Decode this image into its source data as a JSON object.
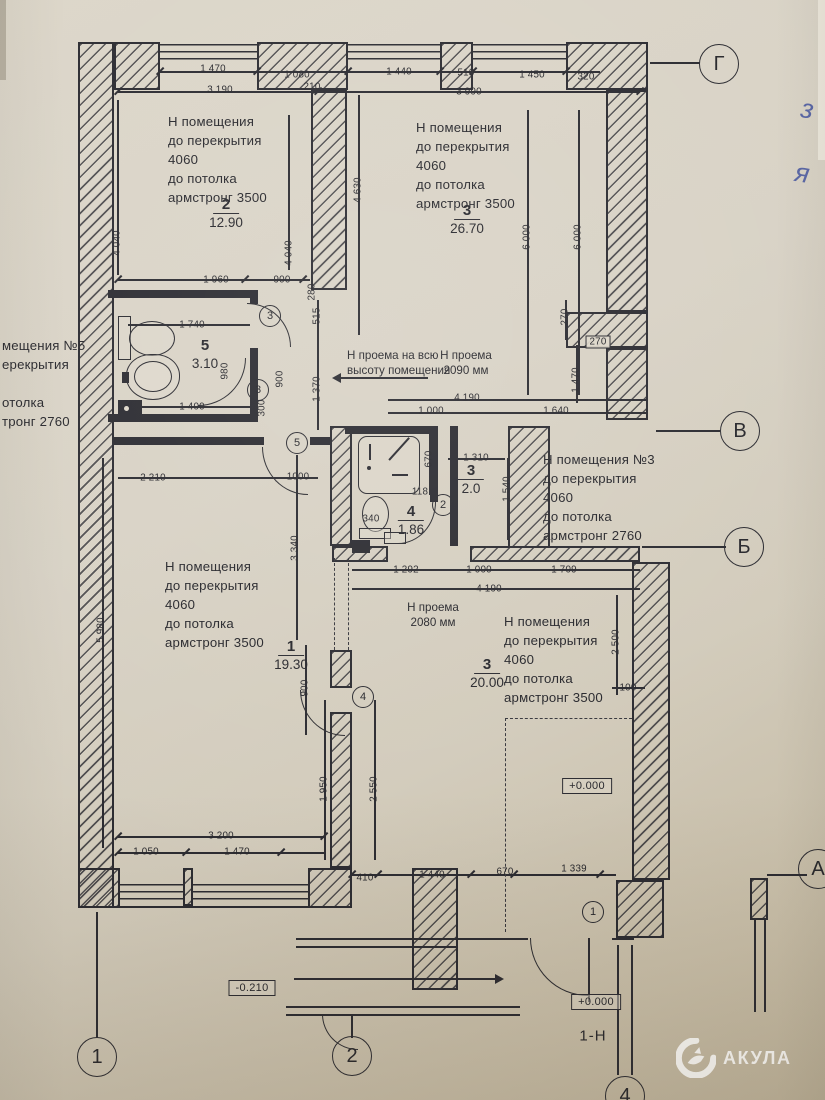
{
  "watermark": {
    "brand": "АКУЛА",
    "logo": "shark-icon"
  },
  "handwriting": {
    "mark1": "з",
    "mark2": "я"
  },
  "entrance_label": "1-Н",
  "icons": {
    "fixtures": [
      "toilet-icon",
      "sink-icon",
      "shower-icon",
      "washer-icon",
      "drain-icon"
    ],
    "watermark_logo": "shark-icon",
    "direction_arrow": "right-arrow-icon",
    "opening_arrow": "left-arrow-icon"
  },
  "axes": [
    {
      "label": "Г",
      "x": 719,
      "y": 64
    },
    {
      "label": "В",
      "x": 740,
      "y": 431
    },
    {
      "label": "Б",
      "x": 744,
      "y": 547
    },
    {
      "label": "А",
      "x": 818,
      "y": 869
    },
    {
      "label": "1",
      "x": 97,
      "y": 1057
    },
    {
      "label": "2",
      "x": 352,
      "y": 1056
    },
    {
      "label": "4",
      "x": 625,
      "y": 1096
    }
  ],
  "door_tags": [
    {
      "label": "3",
      "x": 270,
      "y": 316
    },
    {
      "label": "3",
      "x": 258,
      "y": 390
    },
    {
      "label": "5",
      "x": 297,
      "y": 443
    },
    {
      "label": "2",
      "x": 443,
      "y": 505
    },
    {
      "label": "4",
      "x": 363,
      "y": 697
    },
    {
      "label": "1",
      "x": 593,
      "y": 912
    }
  ],
  "rooms": [
    {
      "name": "room-2",
      "note_x": 168,
      "note_y": 112,
      "lines": [
        "Н помещения",
        "до перекрытия",
        "4060",
        "до потолка",
        "армстронг 3500"
      ],
      "num": "2",
      "area": "12.90",
      "num_x": 226,
      "num_y": 196
    },
    {
      "name": "room-3-top",
      "note_x": 416,
      "note_y": 118,
      "lines": [
        "Н помещения",
        "до перекрытия",
        "4060",
        "до потолка",
        "армстронг 3500"
      ],
      "num": "3",
      "area": "26.70",
      "num_x": 467,
      "num_y": 202
    },
    {
      "name": "room-5",
      "num": "5",
      "area": "3.10",
      "num_x": 205,
      "num_y": 337,
      "bar": false
    },
    {
      "name": "room-3-mid",
      "num": "3",
      "area": "2.0",
      "num_x": 471,
      "num_y": 462
    },
    {
      "name": "room-4",
      "num": "4",
      "area": "1.86",
      "num_x": 411,
      "num_y": 503
    },
    {
      "name": "room-1",
      "note_x": 165,
      "note_y": 557,
      "lines": [
        "Н помещения",
        "до перекрытия",
        "4060",
        "до потолка",
        "армстронг 3500"
      ],
      "num": "1",
      "area": "19.30",
      "num_x": 291,
      "num_y": 638
    },
    {
      "name": "room-3-bottom",
      "note_x": 504,
      "note_y": 612,
      "lines": [
        "Н помещения",
        "до перекрытия",
        "4060",
        "до потолка",
        "армстронг 3500"
      ],
      "num": "3",
      "area": "20.00",
      "num_x": 487,
      "num_y": 656
    },
    {
      "name": "note-room-3",
      "note_x": 543,
      "note_y": 450,
      "lines": [
        "Н помещения №3",
        "до перекрытия",
        "4060",
        "до потолка",
        "армстронг 2760"
      ]
    },
    {
      "name": "note-left-cut",
      "note_x": 2,
      "note_y": 336,
      "lines": [
        "мещения №5",
        "ерекрытия",
        "",
        "отолка",
        "тронг 2760"
      ]
    }
  ],
  "openings": [
    {
      "name": "opening-full-height",
      "x": 347,
      "y": 348,
      "lines": [
        "Н проема на всю",
        "высоту помещения"
      ],
      "align": "left"
    },
    {
      "name": "opening-2090",
      "x": 466,
      "y": 348,
      "lines": [
        "Н проема",
        "2090 мм"
      ],
      "align": "center"
    },
    {
      "name": "opening-2080",
      "x": 433,
      "y": 600,
      "lines": [
        "Н проема",
        "2080 мм"
      ],
      "align": "center"
    }
  ],
  "elevations": [
    {
      "text": "+0.000",
      "x": 587,
      "y": 786
    },
    {
      "text": "-0.210",
      "x": 252,
      "y": 988
    },
    {
      "text": "+0.000",
      "x": 596,
      "y": 1002
    }
  ],
  "dimensions": [
    {
      "t": "1 470",
      "x": 213,
      "y": 69
    },
    {
      "t": "1 080",
      "x": 297,
      "y": 75
    },
    {
      "t": "210",
      "x": 312,
      "y": 87
    },
    {
      "t": "3 190",
      "x": 220,
      "y": 90
    },
    {
      "t": "1 440",
      "x": 399,
      "y": 72
    },
    {
      "t": "510",
      "x": 466,
      "y": 73
    },
    {
      "t": "1 450",
      "x": 532,
      "y": 75
    },
    {
      "t": "320",
      "x": 586,
      "y": 77
    },
    {
      "t": "3 990",
      "x": 469,
      "y": 92
    },
    {
      "t": "4 040",
      "x": 117,
      "y": 243,
      "r": 1
    },
    {
      "t": "4 040",
      "x": 289,
      "y": 253,
      "r": 1
    },
    {
      "t": "4 630",
      "x": 358,
      "y": 190,
      "r": 1
    },
    {
      "t": "6 000",
      "x": 527,
      "y": 237,
      "r": 1
    },
    {
      "t": "6 000",
      "x": 578,
      "y": 237,
      "r": 1
    },
    {
      "t": "1 960",
      "x": 216,
      "y": 280
    },
    {
      "t": "900",
      "x": 282,
      "y": 280
    },
    {
      "t": "280",
      "x": 312,
      "y": 292,
      "r": 1
    },
    {
      "t": "1 740",
      "x": 192,
      "y": 325
    },
    {
      "t": "980",
      "x": 225,
      "y": 371,
      "r": 1
    },
    {
      "t": "900",
      "x": 280,
      "y": 379,
      "r": 1
    },
    {
      "t": "515",
      "x": 317,
      "y": 316,
      "r": 1
    },
    {
      "t": "1 370",
      "x": 317,
      "y": 389,
      "r": 1
    },
    {
      "t": "1 400",
      "x": 192,
      "y": 407
    },
    {
      "t": "300",
      "x": 262,
      "y": 408,
      "r": 1
    },
    {
      "t": "270",
      "x": 565,
      "y": 317,
      "r": 1
    },
    {
      "t": "270",
      "x": 598,
      "y": 342,
      "bx": 1
    },
    {
      "t": "1 470",
      "x": 576,
      "y": 380,
      "r": 1
    },
    {
      "t": "4 190",
      "x": 467,
      "y": 398
    },
    {
      "t": "1 000",
      "x": 431,
      "y": 411
    },
    {
      "t": "1 640",
      "x": 556,
      "y": 411
    },
    {
      "t": "2 210",
      "x": 153,
      "y": 478
    },
    {
      "t": "1000",
      "x": 298,
      "y": 477
    },
    {
      "t": "1 310",
      "x": 476,
      "y": 458
    },
    {
      "t": "670",
      "x": 429,
      "y": 459,
      "r": 1
    },
    {
      "t": "1 540",
      "x": 507,
      "y": 489,
      "r": 1
    },
    {
      "t": "118",
      "x": 420,
      "y": 492
    },
    {
      "t": "340",
      "x": 371,
      "y": 519
    },
    {
      "t": "3 340",
      "x": 295,
      "y": 548,
      "r": 1
    },
    {
      "t": "1 292",
      "x": 406,
      "y": 570
    },
    {
      "t": "1 000",
      "x": 479,
      "y": 570
    },
    {
      "t": "1 709",
      "x": 564,
      "y": 570
    },
    {
      "t": "4 190",
      "x": 489,
      "y": 589
    },
    {
      "t": "2 500",
      "x": 616,
      "y": 642,
      "r": 1
    },
    {
      "t": "900",
      "x": 305,
      "y": 688,
      "r": 1
    },
    {
      "t": "100",
      "x": 628,
      "y": 688
    },
    {
      "t": "5 980",
      "x": 101,
      "y": 630,
      "r": 1
    },
    {
      "t": "1 950",
      "x": 324,
      "y": 789,
      "r": 1
    },
    {
      "t": "2 550",
      "x": 374,
      "y": 789,
      "r": 1
    },
    {
      "t": "3 200",
      "x": 221,
      "y": 836
    },
    {
      "t": "1 050",
      "x": 146,
      "y": 852
    },
    {
      "t": "1 470",
      "x": 237,
      "y": 852
    },
    {
      "t": "410",
      "x": 365,
      "y": 878
    },
    {
      "t": "1 440",
      "x": 432,
      "y": 875
    },
    {
      "t": "670",
      "x": 505,
      "y": 872
    },
    {
      "t": "1 339",
      "x": 574,
      "y": 869
    }
  ]
}
